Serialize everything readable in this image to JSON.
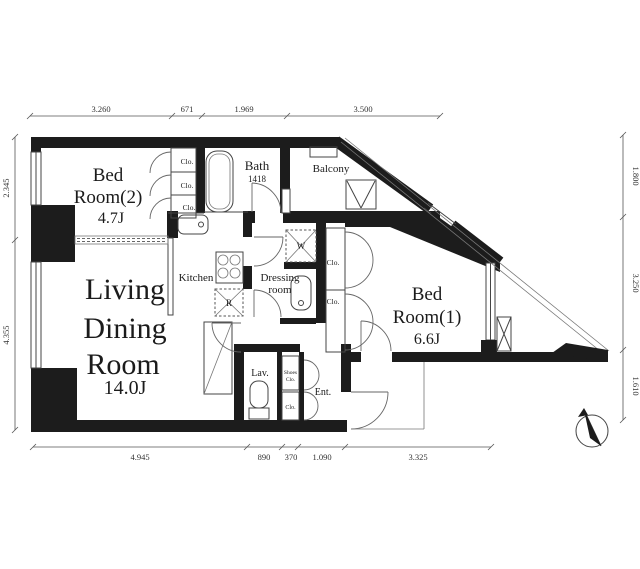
{
  "rooms": {
    "bedroom2": {
      "line1": "Bed",
      "line2": "Room(2)",
      "area": "4.7J"
    },
    "living": {
      "line1": "Living",
      "line2": "Dining",
      "line3": "Room",
      "area": "14.0J"
    },
    "bedroom1": {
      "line1": "Bed",
      "line2": "Room(1)",
      "area": "6.6J"
    },
    "bath": {
      "name": "Bath",
      "size": "1418"
    },
    "kitchen": {
      "name": "Kitchen"
    },
    "balcony": {
      "name": "Balcony"
    },
    "dressing": {
      "line1": "Dressing",
      "line2": "room"
    },
    "lavatory": {
      "name": "Lav."
    },
    "entrance": {
      "name": "Ent."
    },
    "closet": {
      "name": "Clo."
    },
    "shoes_closet": {
      "line1": "Shoes",
      "line2": "Clo."
    }
  },
  "fixtures": {
    "washing_machine": "W",
    "refrigerator": "R"
  },
  "dimensions": {
    "top": [
      "3.260",
      "671",
      "1.969",
      "3.500"
    ],
    "bottom": [
      "4.945",
      "890",
      "370",
      "1.090",
      "3.325"
    ],
    "left": [
      "2.345",
      "4.355"
    ],
    "right": [
      "1.800",
      "3.250",
      "1.610"
    ]
  },
  "colors": {
    "wall": "#1c1c1c",
    "line": "#555555",
    "text": "#1b1b1b"
  }
}
